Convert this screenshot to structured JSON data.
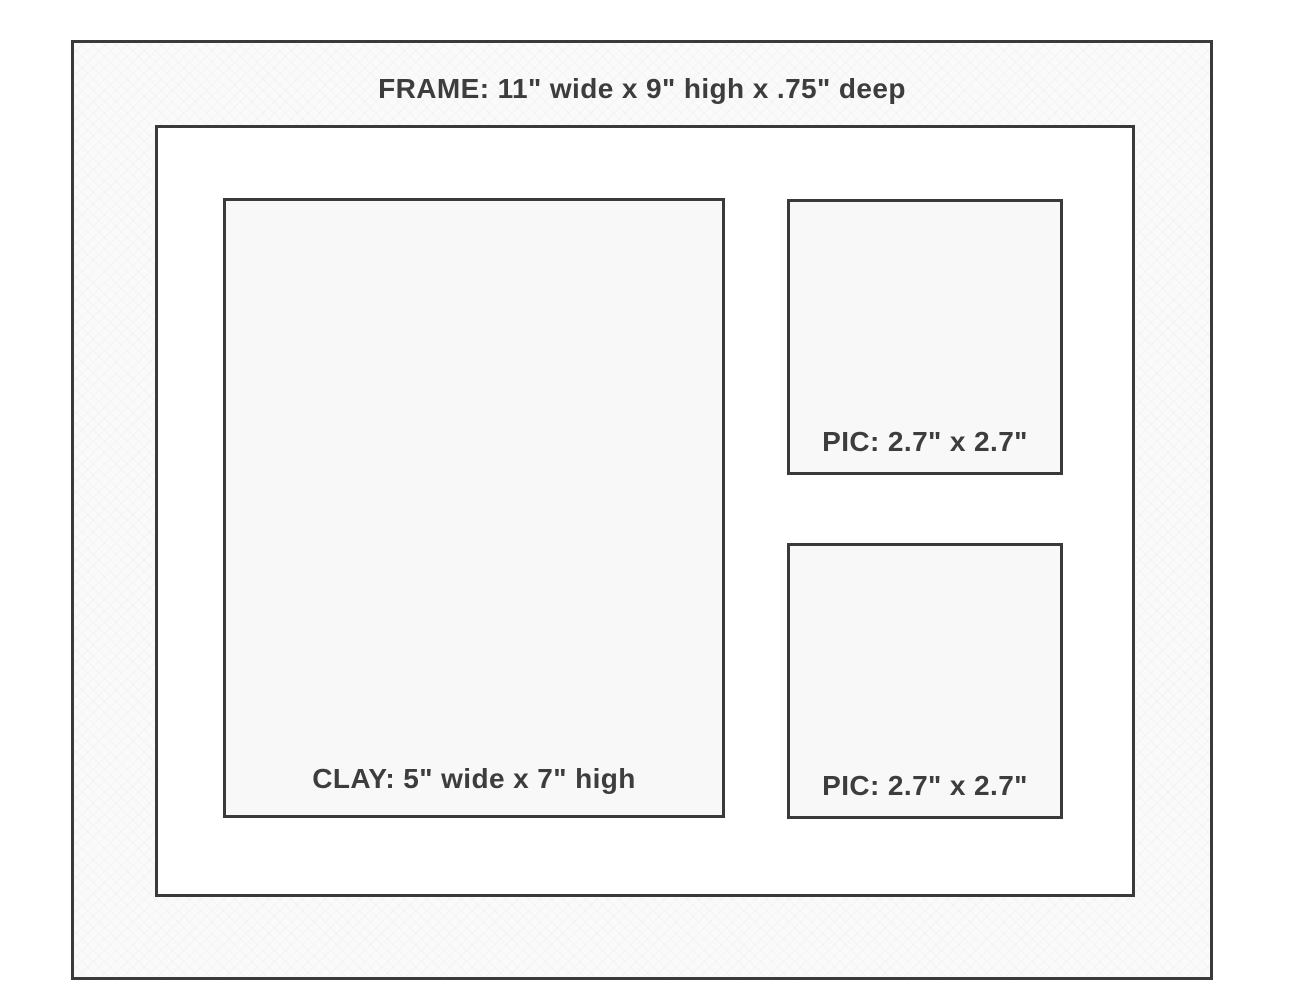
{
  "diagram": {
    "title": "FRAME: 11\" wide x 9\" high x .75\" deep",
    "clay_opening": {
      "label": "CLAY: 5\" wide x 7\" high"
    },
    "pic_openings": [
      {
        "label": "PIC: 2.7\" x 2.7\""
      },
      {
        "label": "PIC: 2.7\" x 2.7\""
      }
    ],
    "colors": {
      "outline": "#3a3a3a",
      "text": "#3d3d3d",
      "frame_fill": "#fafafa",
      "mat_fill": "#ffffff",
      "opening_fill": "#f8f8f8"
    }
  }
}
